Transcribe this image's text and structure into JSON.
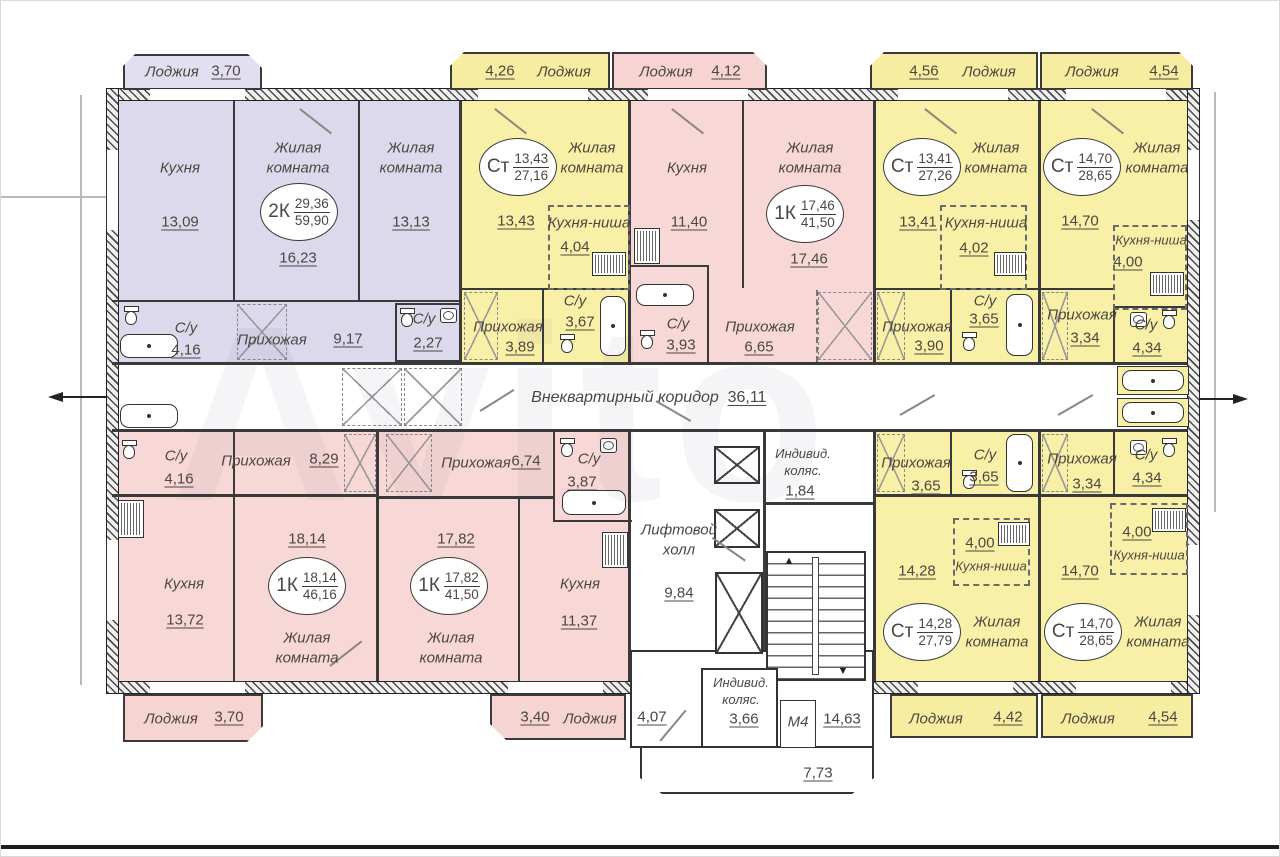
{
  "watermark": {
    "text": "Avito"
  },
  "colors": {
    "purple": "#dcd9ec",
    "pink": "#f8d8d6",
    "yellow": "#f8f0a6",
    "wall": "#3a3a3a"
  },
  "common": {
    "corridor": {
      "label": "Внеквартирный коридор",
      "area": "36,11"
    },
    "lift_hall": {
      "label": "Лифтовой холл",
      "area": "9,84"
    },
    "stroller_top": {
      "label": "Индивид. коляс.",
      "area": "1,84"
    },
    "stroller_bottom": {
      "label": "Индивид. коляс.",
      "area": "3,66"
    },
    "m4": {
      "label": "М4",
      "area": "14,63"
    },
    "passage": {
      "area": "4,07"
    },
    "balcony": {
      "area": "7,73"
    }
  },
  "apts": {
    "a2k": {
      "badge": {
        "type": "2К",
        "top": "29,36",
        "bottom": "59,90"
      },
      "kitchen": {
        "label": "Кухня",
        "area": "13,09"
      },
      "living1": {
        "label": "Жилая комната",
        "area": "16,23"
      },
      "living2": {
        "label": "Жилая комната",
        "area": "13,13"
      },
      "hall": {
        "label": "Прихожая",
        "area": "9,17"
      },
      "bath1": {
        "label": "С/у",
        "area": "4,16"
      },
      "bath2": {
        "label": "С/у",
        "area": "2,27"
      },
      "loggia": {
        "label": "Лоджия",
        "area": "3,70"
      }
    },
    "st1": {
      "badge": {
        "type": "Ст",
        "top": "13,43",
        "bottom": "27,16"
      },
      "living": {
        "label": "Жилая комната",
        "area": "13,43"
      },
      "niche": {
        "label": "Кухня-ниша",
        "area": "4,04"
      },
      "bath": {
        "label": "С/у",
        "area": "3,67"
      },
      "hall": {
        "label": "Прихожая",
        "area": "3,89"
      },
      "loggia": {
        "label": "Лоджия",
        "area": "4,26"
      }
    },
    "k1a": {
      "badge": {
        "type": "1К",
        "top": "17,46",
        "bottom": "41,50"
      },
      "kitchen": {
        "label": "Кухня",
        "area": "11,40"
      },
      "living": {
        "label": "Жилая комната",
        "area": "17,46"
      },
      "bath": {
        "label": "С/у",
        "area": "3,93"
      },
      "hall": {
        "label": "Прихожая",
        "area": "6,65"
      },
      "loggia": {
        "label": "Лоджия",
        "area": "4,12"
      }
    },
    "st2": {
      "badge": {
        "type": "Ст",
        "top": "13,41",
        "bottom": "27,26"
      },
      "living": {
        "label": "Жилая комната",
        "area": "13,41"
      },
      "niche": {
        "label": "Кухня-ниша",
        "area": "4,02"
      },
      "bath": {
        "label": "С/у",
        "area": "3,65"
      },
      "hall": {
        "label": "Прихожая",
        "area": "3,90"
      },
      "loggia": {
        "label": "Лоджия",
        "area": "4,56"
      }
    },
    "st3": {
      "badge": {
        "type": "Ст",
        "top": "14,70",
        "bottom": "28,65"
      },
      "living": {
        "label": "Жилая комната",
        "area": "14,70"
      },
      "niche": {
        "label": "Кухня-ниша",
        "area": "4,00"
      },
      "bath": {
        "label": "С/у",
        "area": "4,34"
      },
      "hall": {
        "label": "Прихожая",
        "area": "3,34"
      },
      "loggia": {
        "label": "Лоджия",
        "area": "4,54"
      }
    },
    "k1b": {
      "badge": {
        "type": "1К",
        "top": "18,14",
        "bottom": "46,16"
      },
      "kitchen": {
        "label": "Кухня",
        "area": "13,72"
      },
      "living": {
        "label": "Жилая комната",
        "area": "18,14"
      },
      "hall": {
        "label": "Прихожая",
        "area": "8,29"
      },
      "bath": {
        "label": "С/у",
        "area": "4,16"
      },
      "loggia": {
        "label": "Лоджия",
        "area": "3,70"
      }
    },
    "k1c": {
      "badge": {
        "type": "1К",
        "top": "17,82",
        "bottom": "41,50"
      },
      "kitchen": {
        "label": "Кухня",
        "area": "11,37"
      },
      "living": {
        "label": "Жилая комната",
        "area": "17,82"
      },
      "hall": {
        "label": "Прихожая",
        "area": "6,74"
      },
      "bath": {
        "label": "С/у",
        "area": "3,87"
      },
      "loggia": {
        "label": "Лоджия",
        "area": "3,40"
      }
    },
    "st4": {
      "badge": {
        "type": "Ст",
        "top": "14,28",
        "bottom": "27,79"
      },
      "living": {
        "label": "Жилая комната",
        "area": "14,28"
      },
      "niche": {
        "label": "Кухня-ниша",
        "area": "4,00"
      },
      "bath": {
        "label": "С/у",
        "area": "3,65"
      },
      "hall": {
        "label": "Прихожая",
        "area": "3,65"
      },
      "loggia": {
        "label": "Лоджия",
        "area": "4,42"
      }
    },
    "st5": {
      "badge": {
        "type": "Ст",
        "top": "14,70",
        "bottom": "28,65"
      },
      "living": {
        "label": "Жилая комната",
        "area": "14,70"
      },
      "niche": {
        "label": "Кухня-ниша",
        "area": "4,00"
      },
      "bath": {
        "label": "С/у",
        "area": "4,34"
      },
      "hall": {
        "label": "Прихожая",
        "area": "3,34"
      },
      "loggia": {
        "label": "Лоджия",
        "area": "4,54"
      }
    }
  }
}
